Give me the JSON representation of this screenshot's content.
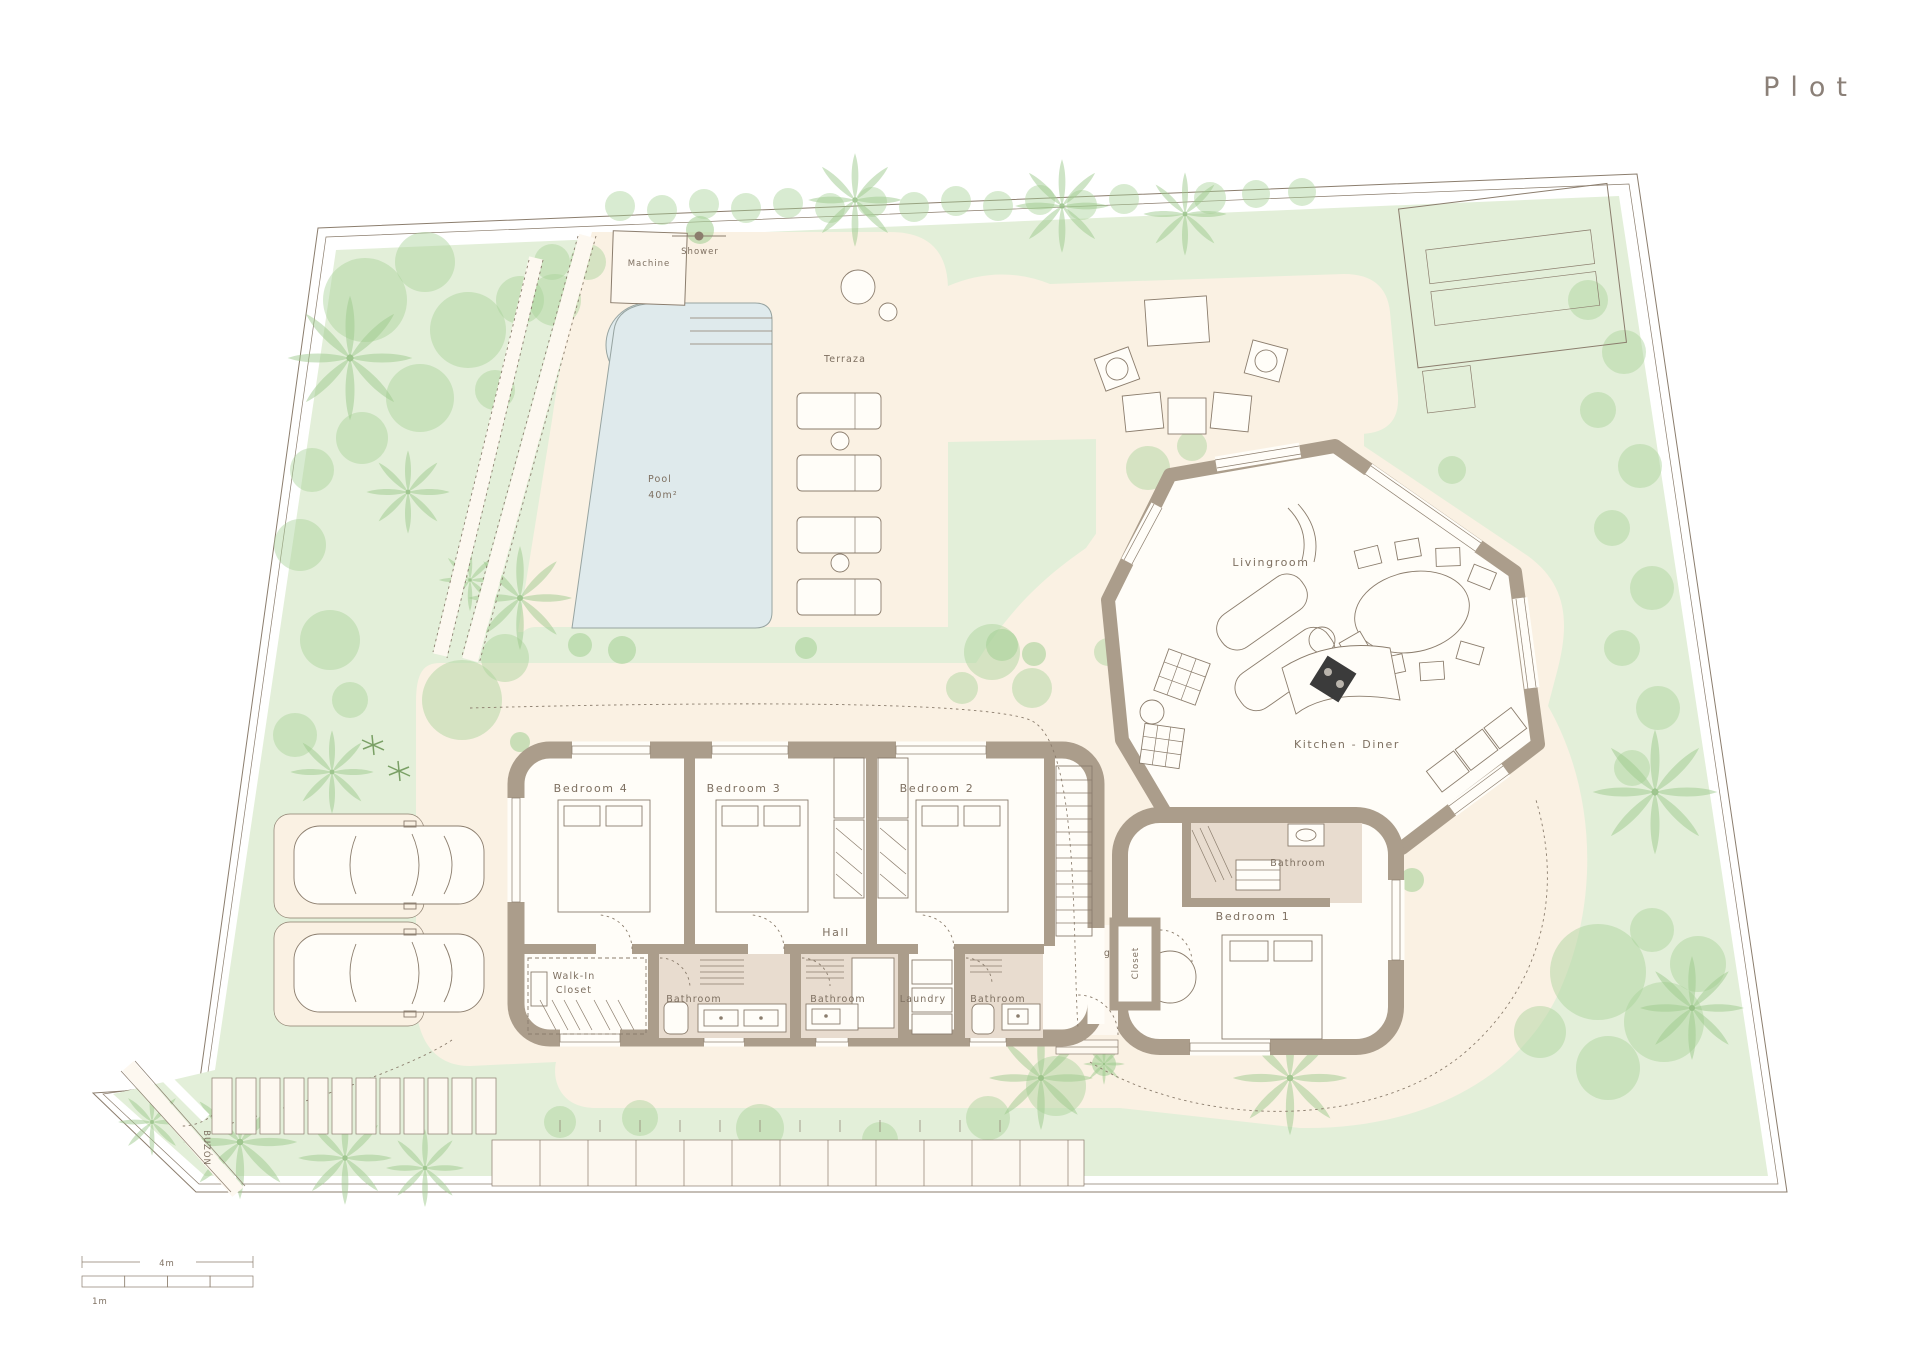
{
  "title": "Plot",
  "colors": {
    "paper": "#ffffff",
    "lawn": "#e3efd9",
    "tree": "#a9d29a",
    "cream": "#faf1e3",
    "pool": "#dfeaec",
    "wall": "#ab9d8b",
    "line": "#8b7d6d",
    "text": "#7d6f60",
    "bath": "#e8dccf",
    "bar": "#b7a794"
  },
  "site": {
    "machine": "Machine",
    "shower": "Shower",
    "terrace": "Terraza",
    "pool": "Pool",
    "pool_area": "40m²",
    "mailbox": "BUZÓN"
  },
  "rooms": {
    "bedroom4": "Bedroom 4",
    "bedroom3": "Bedroom 3",
    "bedroom2": "Bedroom 2",
    "bedroom1": "Bedroom 1",
    "hall": "Hall",
    "walk_in_1": "Walk-In",
    "walk_in_2": "Closet",
    "bath_a": "Bathroom",
    "bath_b": "Bathroom",
    "bath_c": "Bathroom",
    "bath_d": "Bathroom",
    "laundry": "Laundry",
    "receiving_1": "Receiving",
    "receiving_2": "Hall",
    "closet": "Closet",
    "kitchen": "Kitchen - Diner",
    "living": "Livingroom"
  },
  "scale": {
    "major": "4m",
    "minor": "1m"
  }
}
